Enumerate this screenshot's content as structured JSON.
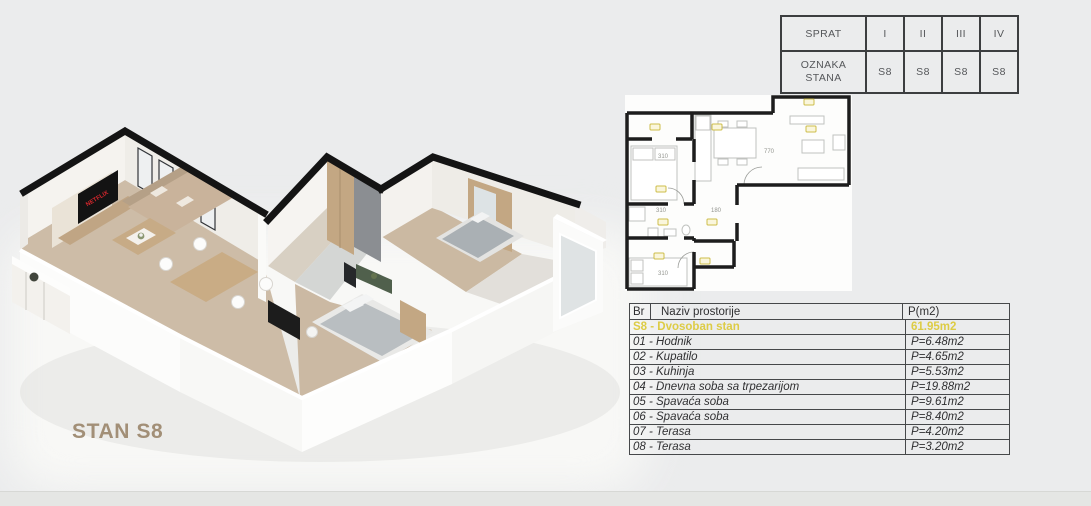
{
  "unit": {
    "label": "STAN S8"
  },
  "floor_table": {
    "row1_header": "SPRAT",
    "row2_header": "OZNAKA STANA",
    "floors": [
      "I",
      "II",
      "III",
      "IV"
    ],
    "units": [
      "S8",
      "S8",
      "S8",
      "S8"
    ]
  },
  "rooms_table": {
    "headers": {
      "br": "Br",
      "name": "Naziv prostorije",
      "area": "P(m2)"
    },
    "summary": {
      "name": "S8 - Dvosoban stan",
      "area": "61.95m2"
    },
    "rows": [
      {
        "name": "01 - Hodnik",
        "area": "P=6.48m2"
      },
      {
        "name": "02 - Kupatilo",
        "area": "P=4.65m2"
      },
      {
        "name": "03 - Kuhinja",
        "area": "P=5.53m2"
      },
      {
        "name": "04 - Dnevna soba sa trpezarijom",
        "area": "P=19.88m2"
      },
      {
        "name": "05 - Spavaća soba",
        "area": "P=9.61m2"
      },
      {
        "name": "06 - Spavaća soba",
        "area": "P=8.40m2"
      },
      {
        "name": "07 - Terasa",
        "area": "P=4.20m2"
      },
      {
        "name": "08 - Terasa",
        "area": "P=3.20m2"
      }
    ]
  },
  "plan_2d": {
    "dims": {
      "bedroom_05": "310",
      "bathroom": "310",
      "hallway": "180",
      "living": "770",
      "bedroom_06": "310"
    }
  },
  "iso_3d": {
    "tv_brand": "NETFLIX"
  },
  "colors": {
    "page_background": "#ebeced",
    "accent_yellow": "#ddcc45",
    "table_border": "#46484a",
    "wall_black": "#141414",
    "wood": "#c3a783",
    "floor_wood": "#cdbca7",
    "stan_label": "#a28f77",
    "netflix_red": "#d7272d"
  }
}
